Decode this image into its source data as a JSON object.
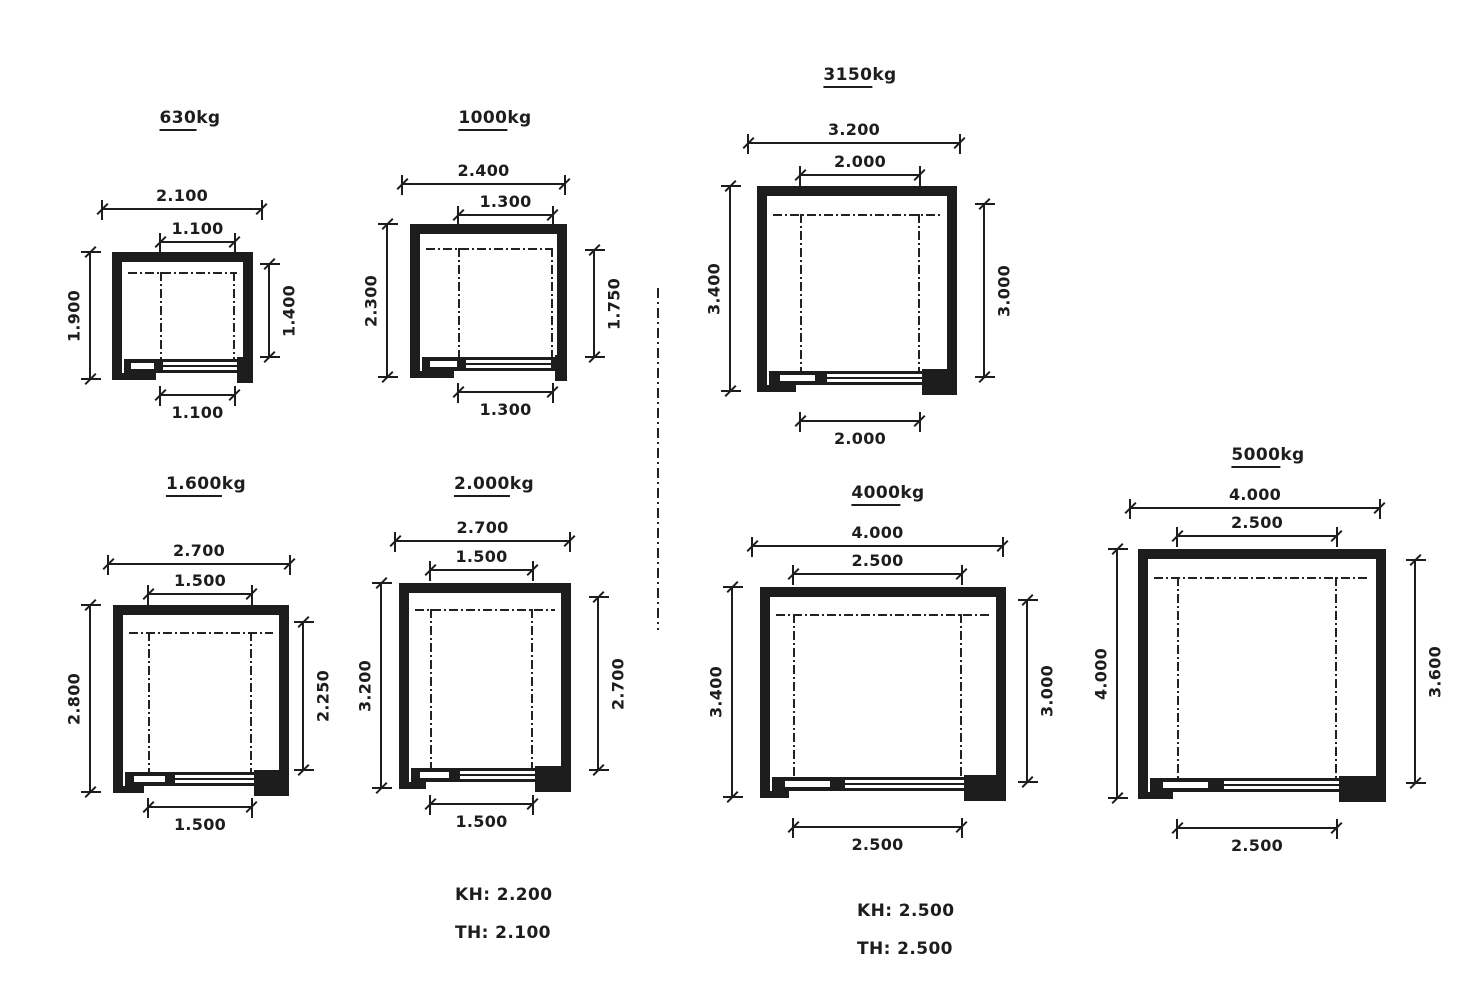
{
  "drawing": {
    "colors": {
      "ink": "#1d1d1d",
      "paper": "#ffffff"
    }
  },
  "diagrams": [
    {
      "capacity": "630",
      "unit": "kg",
      "dims": {
        "shaft_width": "2.100",
        "car_width": "1.100",
        "shaft_depth": "1.900",
        "car_depth": "1.400",
        "door_width": "1.100"
      }
    },
    {
      "capacity": "1000",
      "unit": "kg",
      "dims": {
        "shaft_width": "2.400",
        "car_width": "1.300",
        "shaft_depth": "2.300",
        "car_depth": "1.750",
        "door_width": "1.300"
      }
    },
    {
      "capacity": "1.600",
      "unit": "kg",
      "dims": {
        "shaft_width": "2.700",
        "car_width": "1.500",
        "shaft_depth": "2.800",
        "car_depth": "2.250",
        "door_width": "1.500"
      }
    },
    {
      "capacity": "2.000",
      "unit": "kg",
      "dims": {
        "shaft_width": "2.700",
        "car_width": "1.500",
        "shaft_depth": "3.200",
        "car_depth": "2.700",
        "door_width": "1.500"
      }
    },
    {
      "capacity": "3150",
      "unit": "kg",
      "dims": {
        "shaft_width": "3.200",
        "car_width": "2.000",
        "shaft_depth": "3.400",
        "car_depth": "3.000",
        "door_width": "2.000"
      }
    },
    {
      "capacity": "4000",
      "unit": "kg",
      "dims": {
        "shaft_width": "4.000",
        "car_width": "2.500",
        "shaft_depth": "3.400",
        "car_depth": "3.000",
        "door_width": "2.500"
      }
    },
    {
      "capacity": "5000",
      "unit": "kg",
      "dims": {
        "shaft_width": "4.000",
        "car_width": "2.500",
        "shaft_depth": "4.000",
        "car_depth": "3.600",
        "door_width": "2.500"
      }
    }
  ],
  "notes": [
    {
      "lines": [
        "KH: 2.200",
        "TH: 2.100"
      ]
    },
    {
      "lines": [
        "KH: 2.500",
        "TH: 2.500"
      ]
    }
  ]
}
